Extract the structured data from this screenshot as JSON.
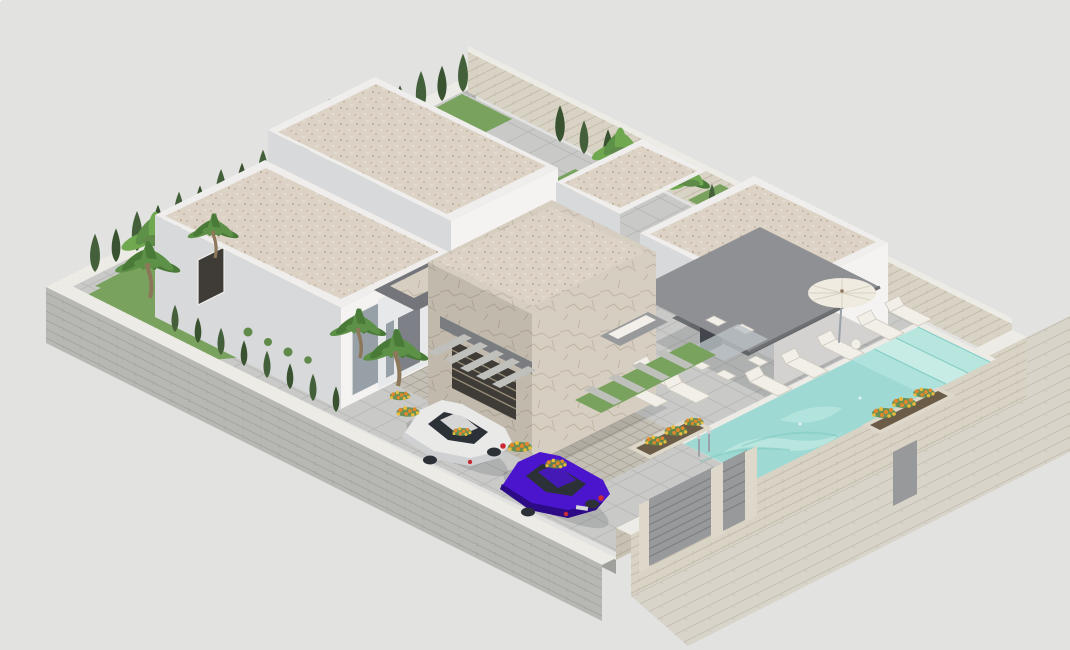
{
  "meta": {
    "title": "3D isometric villa rendering",
    "description": "Isometric 3D architectural rendering of a modern single-storey villa plot: three white flat-roofed volumes with beige gravel roofs, a stone-clad garage volume with a slatted window, a grey entrance porch, a grey canvas awning over a covered terrace, a turquoise swimming pool with steps and a chrome ladder, white sun loungers, a parasol, a glass dining set, a white car and a purple car parked on a paver driveway, raised planters with orange flowers, palm trees and a cypress hedge inside grey and beige masonry perimeter walls with grey entrance gates and an outside pavement, all on a plain light grey background."
  },
  "colors": {
    "background": "#e2e2e1",
    "white_wall": "#f4f3f1",
    "white_wall_shade": "#d8d9db",
    "white_wall_dark": "#c9cacd",
    "parapet": "#efeeec",
    "coping": "#edebe5",
    "pillar_stone": "#ddd8ca",
    "roof_gravel": "#dcd3c6",
    "gravel_dot_a": "#c8baa6",
    "gravel_dot_b": "#b8a993",
    "gravel_dot_c": "#eae4d9",
    "stone": "#d6cec0",
    "stone_crack": "#a79c87",
    "gray_brick": "#b7b8b4",
    "gray_brick_line": "#a3a4a0",
    "beige_wall": "#d9d3c5",
    "beige_wall_line": "#c3bbaa",
    "terrace_tile": "#c9cac8",
    "terrace_line": "#b8b9b7",
    "paver": "#c4bfb5",
    "paver_line": "#a9a397",
    "sidewalk": "#d8d4ca",
    "sidewalk_line": "#c4bfb3",
    "pool_water": "#9edad3",
    "pool_light": "#cdeee8",
    "pool_step": "#b7e6df",
    "pool_line": "#85cec6",
    "pool_dark": "#79c5bd",
    "awning": "#8f9094",
    "awning_edge": "#6f7073",
    "porch_shade": "#6b6e71",
    "glass": "#97a0a7",
    "glass_dark": "#454a50",
    "door_gray": "#7d8187",
    "gate_gray": "#97999b",
    "gate_line": "#7c7e80",
    "window_dark": "#3f3c37",
    "slat_line": "#9a8f79",
    "cypress_a": "#44603a",
    "cypress_b": "#39522f",
    "palm_a": "#5e9148",
    "palm_b": "#4a7a38",
    "banana": "#6fa84f",
    "grass": "#79a25e",
    "grass_dark": "#5f8a49",
    "flower_orange": "#e0872b",
    "flower_yellow": "#e9bc3c",
    "trunk": "#8d775a",
    "car_white": "#e9e9e8",
    "car_white_shade": "#cfd0d1",
    "car_purple": "#4a15cd",
    "car_purple_dark": "#2e0b86",
    "car_window": "#2c3138",
    "taillight": "#c92a33",
    "chrome": "#9aa1a7",
    "slab_gray": "#bfc0bc",
    "soil": "#6b5c48",
    "shadow": "rgba(60,62,66,0.18)",
    "table_glass": "#b9c0c4",
    "cushion": "#f2efe8",
    "lounger_edge": "#cfcabf",
    "sofa_gray": "#97999b",
    "umbrella_canvas": "#f0ebe1",
    "umbrella_rib": "#d8d1c2"
  },
  "scene": {
    "view": "isometric",
    "objects": [
      "back-house-volume",
      "left-house-volume",
      "right-house-volume",
      "roof-wing",
      "stone-garage-volume",
      "slatted-garage-window",
      "entrance-porch",
      "entrance-door",
      "terrace-awning",
      "covered-terrace",
      "swimming-pool",
      "pool-steps",
      "pool-ladder",
      "parasol",
      "sun-loungers",
      "garden-sofa",
      "glass-dining-set",
      "white-car",
      "purple-car",
      "driveway",
      "stepping-stone-path",
      "flower-planters",
      "orange-flowers",
      "palm-trees",
      "cypress-hedge",
      "banana-plants",
      "perimeter-wall-gray",
      "perimeter-wall-beige",
      "driveway-gate",
      "pedestrian-gate",
      "utility-door",
      "street-pavement"
    ]
  }
}
